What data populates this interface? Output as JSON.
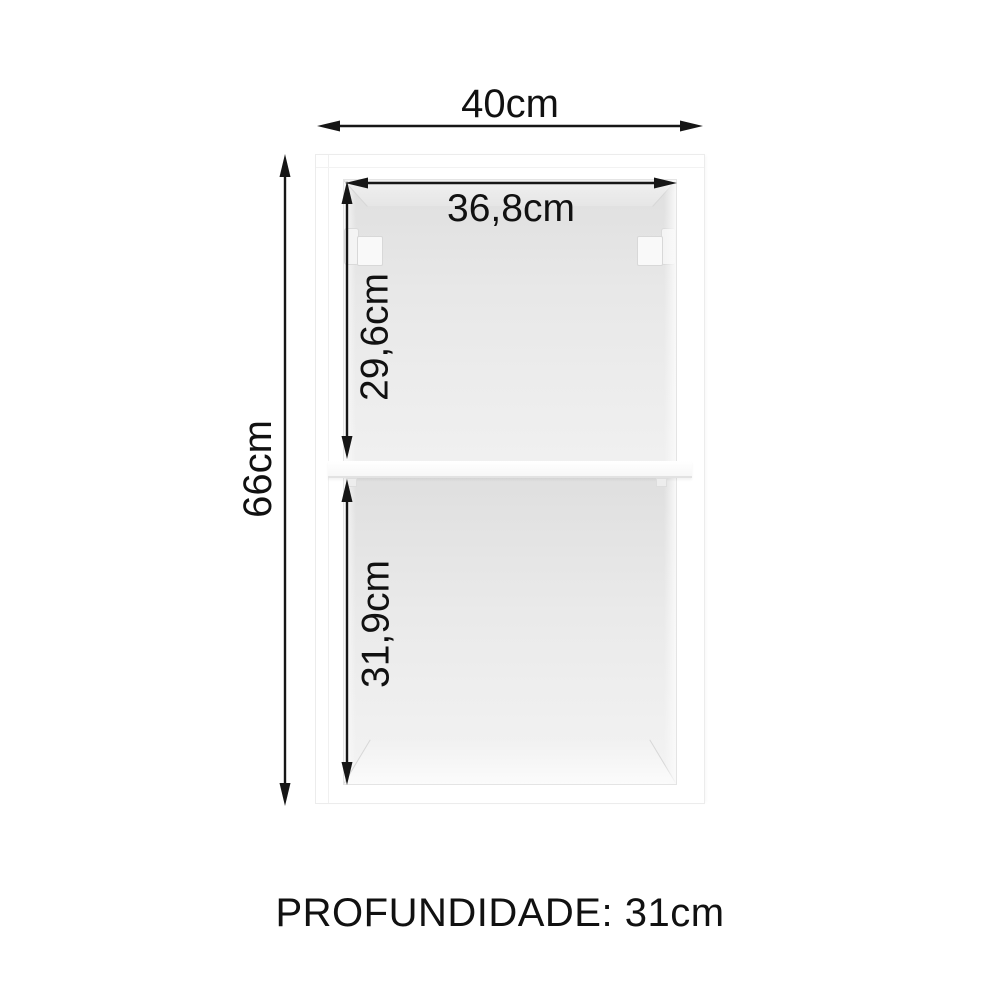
{
  "diagram": {
    "kind": "furniture-dimension-diagram",
    "dimensions": {
      "outer_width": "40cm",
      "outer_height": "66cm",
      "inner_width": "36,8cm",
      "upper_compartment_height": "29,6cm",
      "lower_compartment_height": "31,9cm"
    },
    "depth_label": "PROFUNDIDADE: 31cm",
    "colors": {
      "background": "#ffffff",
      "dimension_line": "#161616",
      "label_text": "#111111",
      "cabinet_face": "#ffffff",
      "interior_shade_dark": "#dfdfdf",
      "interior_shade_light": "#f3f3f3",
      "edge_line": "#e4e4e4"
    }
  }
}
